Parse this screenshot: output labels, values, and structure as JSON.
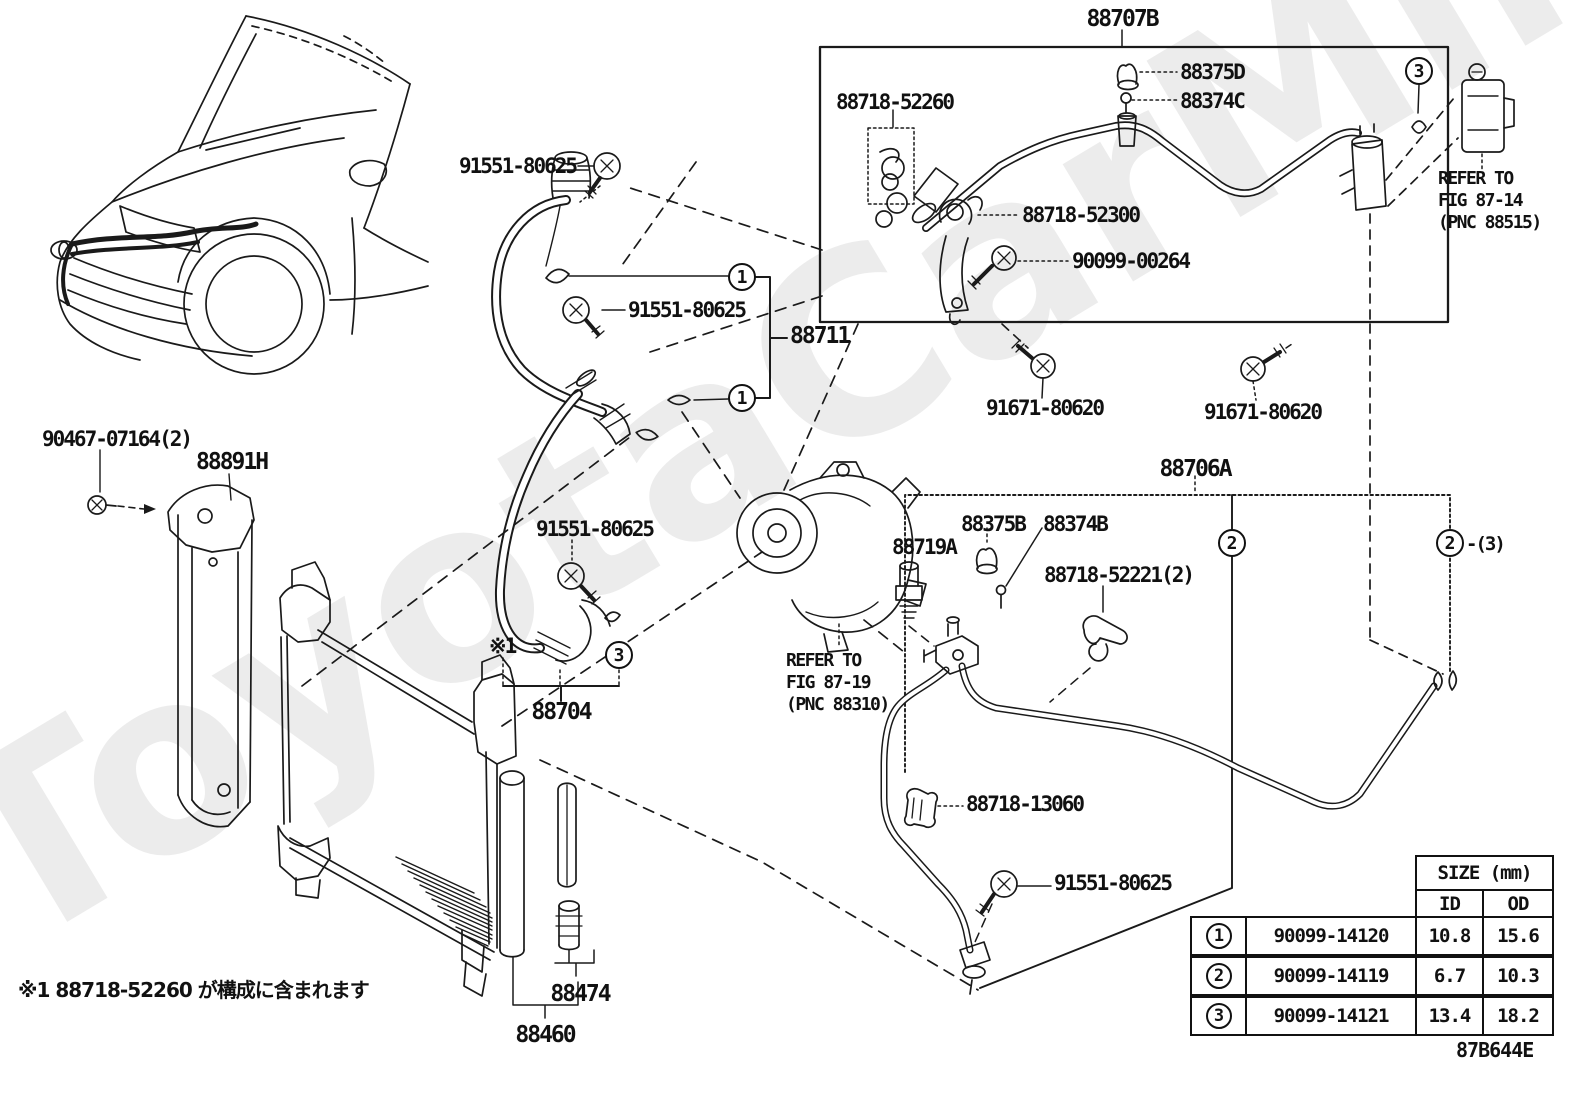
{
  "watermark": "ToyotaCarMine.ru",
  "footnote": "※1 88718-52260 が構成に含まれます",
  "diagram_code": "87B644E",
  "labels": [
    {
      "text": "88707B",
      "x": 1122,
      "y": 8,
      "size": 23,
      "align": "center"
    },
    {
      "text": "88375D",
      "x": 1180,
      "y": 62
    },
    {
      "text": "88374C",
      "x": 1180,
      "y": 91
    },
    {
      "text": "88718-52260",
      "x": 836,
      "y": 92
    },
    {
      "text": "88718-52300",
      "x": 1022,
      "y": 205
    },
    {
      "text": "90099-00264",
      "x": 1072,
      "y": 251
    },
    {
      "text": "91551-80625",
      "x": 459,
      "y": 156
    },
    {
      "text": "91551-80625",
      "x": 628,
      "y": 300
    },
    {
      "text": "88711",
      "x": 790,
      "y": 325,
      "size": 23
    },
    {
      "text": "91671-80620",
      "x": 986,
      "y": 398
    },
    {
      "text": "91671-80620",
      "x": 1204,
      "y": 402
    },
    {
      "text": "88706A",
      "x": 1195,
      "y": 458,
      "size": 23,
      "align": "center"
    },
    {
      "text": "88719A",
      "x": 892,
      "y": 537
    },
    {
      "text": "88375B",
      "x": 961,
      "y": 514
    },
    {
      "text": "88374B",
      "x": 1043,
      "y": 514
    },
    {
      "text": "88718-52221(2)",
      "x": 1044,
      "y": 565
    },
    {
      "text": "88718-13060",
      "x": 966,
      "y": 794
    },
    {
      "text": "91551-80625",
      "x": 1054,
      "y": 873
    },
    {
      "text": "91551-80625",
      "x": 536,
      "y": 519
    },
    {
      "text": "88704",
      "x": 561,
      "y": 701,
      "size": 23,
      "align": "center"
    },
    {
      "text": "※1",
      "x": 489,
      "y": 636
    },
    {
      "text": "90467-07164(2)",
      "x": 42,
      "y": 429
    },
    {
      "text": "88891H",
      "x": 196,
      "y": 451,
      "size": 23
    },
    {
      "text": "88474",
      "x": 580,
      "y": 983,
      "size": 23,
      "align": "center"
    },
    {
      "text": "88460",
      "x": 545,
      "y": 1024,
      "size": 23,
      "align": "center"
    }
  ],
  "callouts": [
    {
      "n": "1",
      "x": 742,
      "y": 277
    },
    {
      "n": "1",
      "x": 742,
      "y": 398
    },
    {
      "n": "3",
      "x": 1419,
      "y": 71
    },
    {
      "n": "3",
      "x": 619,
      "y": 655
    },
    {
      "n": "2",
      "x": 1232,
      "y": 543
    },
    {
      "n": "2",
      "x": 1450,
      "y": 543,
      "suffix": "-(3)"
    }
  ],
  "refer_blocks": [
    {
      "x": 1438,
      "y": 168,
      "lines": [
        "REFER TO",
        "FIG 87-14",
        "(PNC 88515)"
      ]
    },
    {
      "x": 786,
      "y": 650,
      "lines": [
        "REFER TO",
        "FIG 87-19",
        "(PNC 88310)"
      ]
    }
  ],
  "size_table": {
    "title": "SIZE (mm)",
    "col_id": "ID",
    "col_od": "OD",
    "rows": [
      {
        "mark": "1",
        "part": "90099-14120",
        "id": "10.8",
        "od": "15.6"
      },
      {
        "mark": "2",
        "part": "90099-14119",
        "id": "6.7",
        "od": "10.3"
      },
      {
        "mark": "3",
        "part": "90099-14121",
        "id": "13.4",
        "od": "18.2"
      }
    ]
  }
}
